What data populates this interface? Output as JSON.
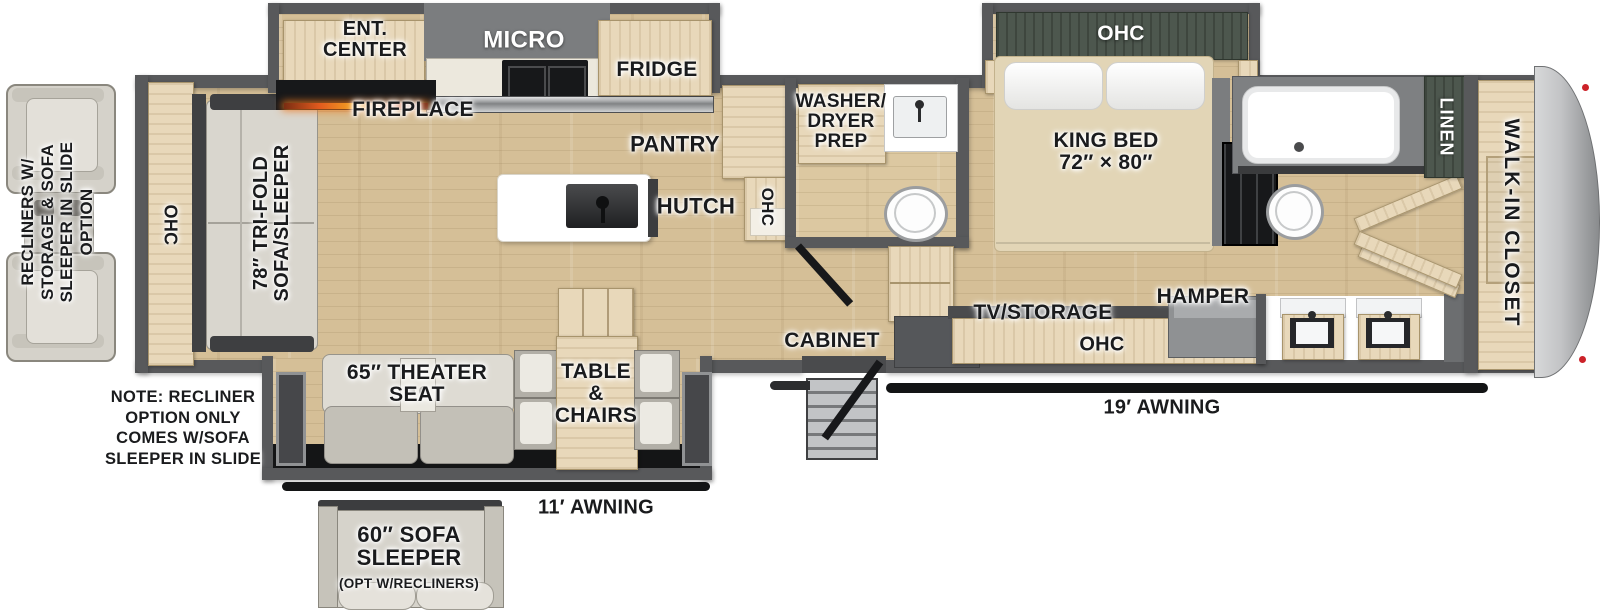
{
  "plan": {
    "labels": {
      "ent_center": "ENT.\nCENTER",
      "micro": "MICRO",
      "fridge": "FRIDGE",
      "fireplace": "FIREPLACE",
      "pantry": "PANTRY",
      "hutch": "HUTCH",
      "ohc_kitchen": "OHC",
      "washer_dryer_prep": "WASHER/\nDRYER\nPREP",
      "ohc_bedroom": "OHC",
      "king_bed": "KING BED\n72″ × 80″",
      "linen": "LINEN",
      "walk_in_closet": "WALK-IN CLOSET",
      "ohc_rear": "OHC",
      "sofa": "78″ TRI-FOLD\nSOFA/SLEEPER",
      "theater_seat": "65″ THEATER\nSEAT",
      "table_chairs": "TABLE\n&\nCHAIRS",
      "cabinet": "CABINET",
      "tv_storage": "TV/STORAGE",
      "hamper": "HAMPER",
      "ohc_bottom": "OHC",
      "awning_11": "11′ AWNING",
      "awning_19": "19′ AWNING",
      "recliner_option": "RECLINERS W/\nSTORAGE & SOFA\nSLEEPER IN SLIDE\nOPTION",
      "note": "NOTE: RECLINER\nOPTION ONLY\nCOMES W/SOFA\nSLEEPER IN SLIDE",
      "sofa_option_main": "60″ SOFA\nSLEEPER",
      "sofa_option_sub": "(OPT W/RECLINERS)"
    },
    "colors": {
      "wall": "#58595b",
      "floor_wood": "#d5bf97",
      "cabinet_wood": "#e8d8ba",
      "accent_green": "#4d574e",
      "awning_black": "#131415",
      "front_cap_gray": "#c3c4c6",
      "label_text": "#1a1b1d"
    }
  }
}
